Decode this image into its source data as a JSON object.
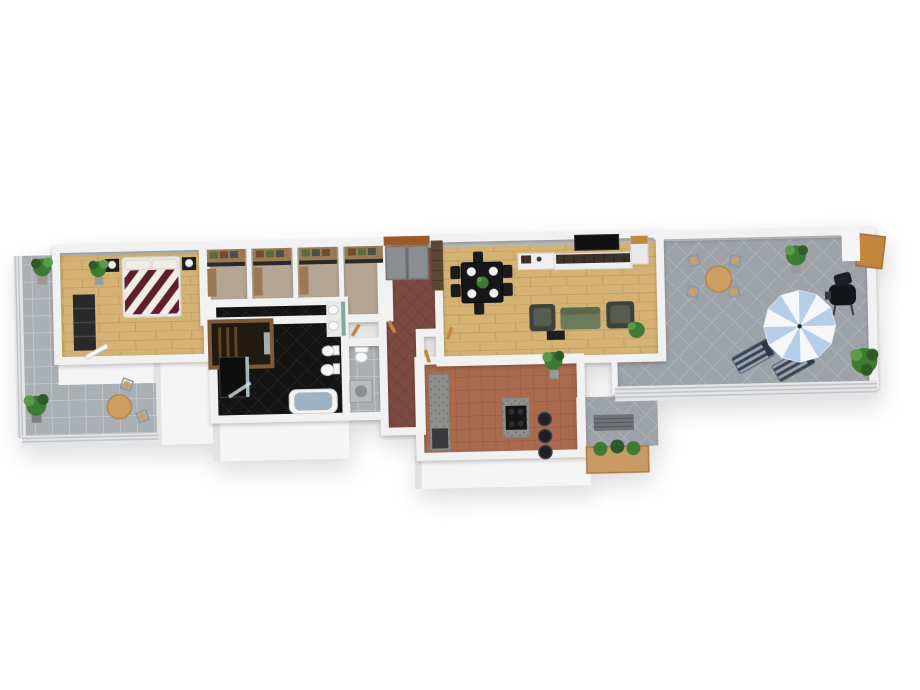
{
  "meta": {
    "title": "3D apartment floor plan rendering",
    "view": "isometric top-down",
    "background": "#ffffff"
  },
  "rooms": [
    {
      "id": "bedroom",
      "name": "Bedroom",
      "floor": "light wood planks"
    },
    {
      "id": "closet-corridor",
      "name": "Walk-in closets",
      "floor": "tan carpet"
    },
    {
      "id": "sauna",
      "name": "Sauna",
      "floor": "dark wood"
    },
    {
      "id": "bathroom",
      "name": "Bathroom",
      "floor": "black diagonal tile"
    },
    {
      "id": "wc-laundry",
      "name": "WC / laundry",
      "floor": "gray tile"
    },
    {
      "id": "entry-hall",
      "name": "Entry hall",
      "floor": "dark red diagonal tile"
    },
    {
      "id": "living-dining",
      "name": "Living / dining room",
      "floor": "light wood planks"
    },
    {
      "id": "kitchen",
      "name": "Kitchen",
      "floor": "terracotta tile"
    },
    {
      "id": "balcony-left",
      "name": "Left balcony",
      "floor": "gray square tile"
    },
    {
      "id": "terrace",
      "name": "Roof terrace",
      "floor": "gray diamond tile"
    },
    {
      "id": "patio",
      "name": "Lower patio strip",
      "floor": "gray diamond tile"
    }
  ],
  "furniture": {
    "bedroom": [
      "double bed with striped duvet",
      "two black nightstands with lamps",
      "dark wardrobe",
      "potted plant",
      "open balcony door"
    ],
    "closets": [
      "four wardrobe niches with shelved clothes"
    ],
    "bathroom": [
      "bathtub",
      "double vanity with mirrors",
      "toilet",
      "bidet",
      "shower"
    ],
    "wc": [
      "toilet",
      "washing machine"
    ],
    "entry": [
      "double gray doors",
      "orange lintel",
      "brick pillar"
    ],
    "living": [
      "dining table with six chairs and plates",
      "wall TV",
      "slatted sideboard",
      "white cabinet",
      "green sofa",
      "two armchairs",
      "coffee table",
      "potted plant"
    ],
    "kitchen": [
      "granite island with cooktop",
      "three bar stools",
      "granite counter",
      "appliance"
    ],
    "terrace": [
      "round table with four chairs",
      "blue-white parasol",
      "two striped sun loungers",
      "barbecue grill",
      "two potted plants",
      "wooden gate"
    ],
    "balcony": [
      "round table",
      "two chairs",
      "two potted plants"
    ],
    "patio": [
      "planter box with plants",
      "floor grate"
    ]
  },
  "counts": {
    "plants": "7",
    "chairs_dining": "6",
    "bar_stools": "3",
    "sun_loungers": "2"
  },
  "colors": {
    "wall": "#f2f2f2",
    "wallEdge": "#dddddd",
    "wallTopBand": "#bdbdbd",
    "wallTopBandLight": "#cfcfcf",
    "faceWhite": "#f5f5f5",
    "faceShade": "#e2e2e2",
    "wood": "#d3b274",
    "woodLine": "#c09e60",
    "carpet": "#b5a594",
    "blackTile": "#141414",
    "blackTileLine": "#303030",
    "hallTile": "#7c4a42",
    "hallTileLine": "#693c35",
    "terracotta": "#a96a4d",
    "terracottaLine": "#96593f",
    "balconyTile": "#aaafb4",
    "balconyTileLine": "#cdd0d3",
    "terraceTile": "#9da2a8",
    "terraceTileLine": "#b6bac0",
    "railing": "#e4e5e7",
    "railingLine": "#bfc1c4",
    "bedStripe": "#5e2028",
    "bedWhite": "#f0ece7",
    "bedBase": "#e9e7e2",
    "nightstand": "#1d1d20",
    "lamp": "#f3f1ec",
    "wardrobe": "#29292c",
    "wardrobeLine": "#4a4a4e",
    "shelfWood": "#9a7a55",
    "clothesGreen": "#5a6b3c",
    "clothesBrown": "#6d4c30",
    "clothesDark": "#4a5048",
    "saunaWood": "#7c5c38",
    "saunaInterior": "#221a10",
    "saunaSlat": "#5e4527",
    "tub": "#f4f4f4",
    "tubInner": "#9eb2c1",
    "fixtureWhite": "#fafafa",
    "fixtureLine": "#c8c8c8",
    "mirror": "#7fa8a0",
    "showerGlass": "#cfe0e4",
    "showerTray": "#0e0e0e",
    "washer": "#b9bcbe",
    "washerDrum": "#8b8f92",
    "doorGray": "#8a8f94",
    "doorGrayLine": "#6f7478",
    "lintel": "#9c5a28",
    "brick": "#5d4632",
    "brickLine": "#49362a",
    "woodDoor": "#c3863f",
    "granite": "#8f8f8b",
    "graniteDot": "#6f6f6b",
    "cooktop": "#141416",
    "burner": "#2e2e33",
    "stool": "#202024",
    "stoolRim": "#3d3d42",
    "tv": "#101013",
    "sideboardWood": "#3e3127",
    "sideboardBase": "#efefef",
    "cabinetWhite": "#e9e9e9",
    "tableDark": "#17171a",
    "chairDark": "#1c1c1f",
    "plate": "#f2f2f2",
    "sofa": "#6b7c5d",
    "sofaDark": "#596a4c",
    "armchair": "#3d423a",
    "armchairSeat": "#565c50",
    "plantGreen": "#3f7a34",
    "plantDark": "#2d5a26",
    "plantLight": "#5c9a4a",
    "pot": "#9a9a9a",
    "potDark": "#7f7f7f",
    "tan": "#cf9e62",
    "tanLine": "#b4854e",
    "metal": "#8f959c",
    "grill": "#141518",
    "grillDark": "#1d1f24",
    "grillDetail": "#3a3a3e",
    "umbrellaBlue": "#b5cde9",
    "umbrellaWhite": "#f5f7f9",
    "umbrellaSeam": "#dde4ec",
    "loungeA": "#3c4454",
    "loungeB": "#9aa2b0",
    "loungePillow": "#2f3642",
    "planter": "#c89a66",
    "planterDark": "#a87b47",
    "grate": "#6f7276",
    "grateLine": "#54575a"
  }
}
